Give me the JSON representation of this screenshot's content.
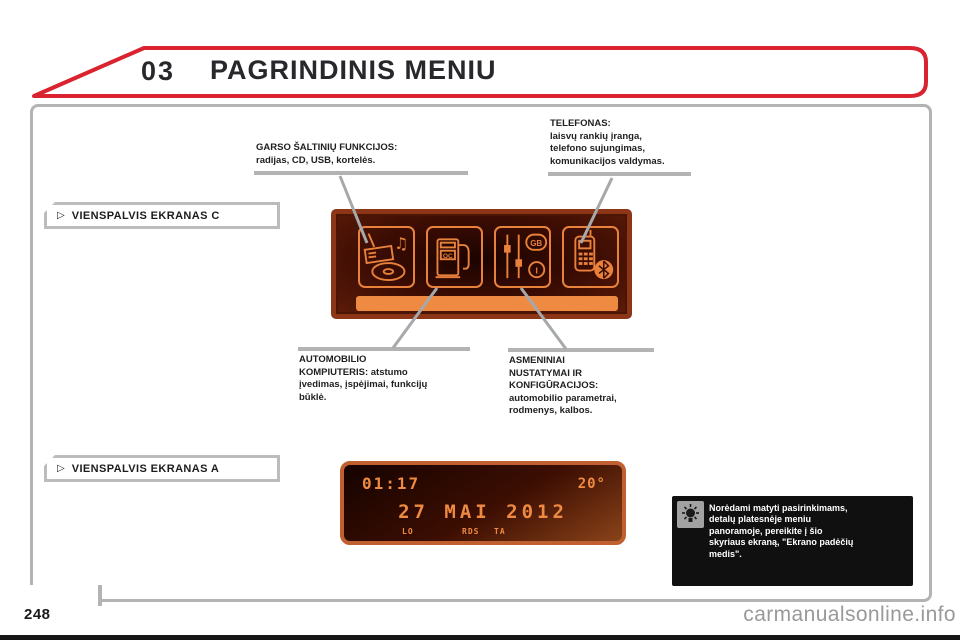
{
  "header": {
    "chapter": "03",
    "title": "PAGRINDINIS MENIU"
  },
  "banners": {
    "arrow": "▷",
    "screen_c": "VIENSPALVIS EKRANAS C",
    "screen_a": "VIENSPALVIS EKRANAS A"
  },
  "callouts": {
    "audio": {
      "line1": "GARSO ŠALTINIŲ FUNKCIJOS:",
      "line2": "radijas, CD, USB, kortelės."
    },
    "phone": {
      "line1": "TELEFONAS:",
      "line2": "laisvų rankių įranga,",
      "line3": "telefono sujungimas,",
      "line4": "komunikacijos valdymas."
    },
    "trip_computer": {
      "line1": "AUTOMOBILIO",
      "line2": "KOMPIUTERIS: atstumo",
      "line3": "įvedimas, įspėjimai, funkcijų",
      "line4": "būklė."
    },
    "personalization": {
      "line1": "ASMENINIAI",
      "line2": "NUSTATYMAI IR",
      "line3": "KONFIGŪRACIJOS:",
      "line4": "automobilio parametrai,",
      "line5": "rodmenys, kalbos."
    }
  },
  "screen_c": {
    "icons": [
      "audio-sources-icon",
      "trip-computer-icon",
      "settings-sliders-icon",
      "phone-bluetooth-icon"
    ],
    "pump_label": "OC",
    "language_badge_1": "GB",
    "language_badge_2": "I"
  },
  "screen_a": {
    "time": "01:17",
    "temperature": "20°",
    "date": "27 MAI 2012",
    "indicator_lo": "LO",
    "indicator_rds": "RDS",
    "indicator_ta": "TA"
  },
  "note": {
    "icon": "bulb-icon",
    "line1": "Norėdami matyti pasirinkimams,",
    "line2": "detalų platesnėje meniu",
    "line3": "panoramoje, pereikite į šio",
    "line4": "skyriaus ekraną, \"Ekrano padėčių",
    "line5": "medis\"."
  },
  "footer": {
    "page_number": "248",
    "watermark": "carmanualsonline.info"
  },
  "colors": {
    "accent_red": "#d9232e",
    "display_orange": "#e8813c",
    "display_bg": "#2a0a02",
    "gray_border": "#b3b3b3"
  }
}
